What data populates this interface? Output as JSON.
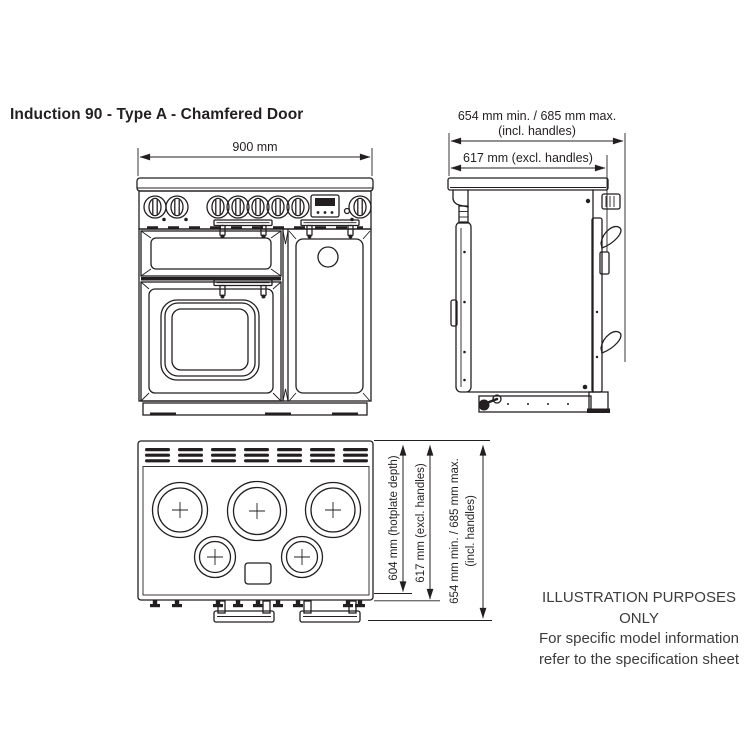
{
  "title": "Induction 90 - Type A - Chamfered Door",
  "dimensions": {
    "front_width": "900 mm",
    "side_depth_incl_line1": "654 mm min. / 685 mm max.",
    "side_depth_incl_line2": "(incl. handles)",
    "side_depth_excl": "617 mm (excl. handles)",
    "top_hotplate_depth": "604 mm (hotplate depth)",
    "top_depth_excl": "617 mm (excl. handles)",
    "top_depth_incl_line1": "654 mm min. / 685 mm max.",
    "top_depth_incl_line2": "(incl. handles)"
  },
  "note": {
    "line1": "ILLUSTRATION PURPOSES ONLY",
    "line2": "For specific model information",
    "line3": "refer to the specification sheet"
  },
  "colors": {
    "line": "#231f20",
    "text": "#231f20",
    "note_text": "#3c3c3c",
    "background": "#ffffff"
  }
}
